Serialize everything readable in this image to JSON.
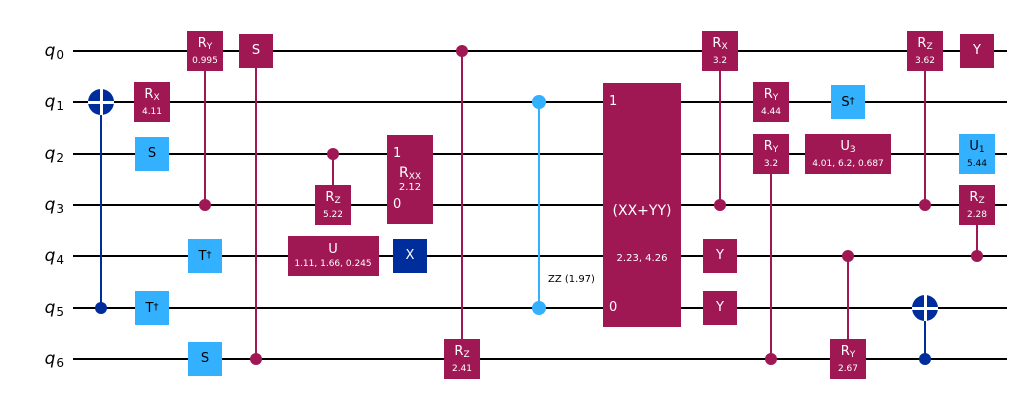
{
  "diagram_type": "quantum-circuit",
  "colors": {
    "rotation": "#9F1853",
    "clifford": "#33B1FF",
    "pauli": "#002D9C",
    "wire": "#000000",
    "zz": "#33B1FF",
    "background": "#ffffff",
    "text_on_dark": "#ffffff",
    "text_on_light": "#000000"
  },
  "qubits": [
    {
      "label": "q",
      "sub": "0"
    },
    {
      "label": "q",
      "sub": "1"
    },
    {
      "label": "q",
      "sub": "2"
    },
    {
      "label": "q",
      "sub": "3"
    },
    {
      "label": "q",
      "sub": "4"
    },
    {
      "label": "q",
      "sub": "5"
    },
    {
      "label": "q",
      "sub": "6"
    }
  ],
  "circuit": {
    "gates": [
      {
        "name": "cx-gate",
        "type": "cx",
        "column": 1,
        "control": 5,
        "target": 1
      },
      {
        "name": "rx-gate",
        "type": "gate",
        "column": 2,
        "qubit": 1,
        "label": "R",
        "sub": "X",
        "param": "4.11",
        "color": "rotation"
      },
      {
        "name": "s-gate",
        "type": "gate",
        "column": 2,
        "qubit": 2,
        "label": "S",
        "color": "clifford"
      },
      {
        "name": "tdg-gate",
        "type": "gate",
        "column": 2,
        "qubit": 5,
        "label": "T",
        "sup": "†",
        "color": "clifford"
      },
      {
        "name": "cry-gate",
        "type": "gate",
        "column": 3,
        "qubit": 0,
        "label": "R",
        "sub": "Y",
        "param": "0.995",
        "color": "rotation",
        "control": 3
      },
      {
        "name": "tdg-gate",
        "type": "gate",
        "column": 3,
        "qubit": 4,
        "label": "T",
        "sup": "†",
        "color": "clifford"
      },
      {
        "name": "s-gate",
        "type": "gate",
        "column": 3,
        "qubit": 6,
        "label": "S",
        "color": "clifford"
      },
      {
        "name": "cs-gate",
        "type": "gate",
        "column": 4,
        "qubit": 0,
        "label": "S",
        "color": "rotation",
        "control": 6
      },
      {
        "name": "crz-gate",
        "type": "gate",
        "column": 5,
        "qubit": 3,
        "label": "R",
        "sub": "Z",
        "param": "5.22",
        "color": "rotation",
        "control": 2
      },
      {
        "name": "u-gate",
        "type": "gate",
        "column": 5,
        "qubit": 4,
        "label": "U",
        "param": "1.11, 1.66, 0.245",
        "color": "rotation"
      },
      {
        "name": "rxx-gate",
        "type": "multibox",
        "column": 6,
        "top": 2,
        "bottom": 3,
        "label": "R",
        "sub": "XX",
        "param": "2.12",
        "color": "rotation",
        "ports": [
          {
            "qubit": 2,
            "label": "1"
          },
          {
            "qubit": 3,
            "label": "0"
          }
        ]
      },
      {
        "name": "x-gate",
        "type": "gate",
        "column": 6,
        "qubit": 4,
        "label": "X",
        "color": "pauli"
      },
      {
        "name": "crz-gate",
        "type": "gate",
        "column": 7,
        "qubit": 6,
        "label": "R",
        "sub": "Z",
        "param": "2.41",
        "color": "rotation",
        "control": 0
      },
      {
        "name": "rzz-gate",
        "type": "zz",
        "column": 8,
        "qubit_a": 1,
        "qubit_b": 5,
        "label": "ZZ (1.97)"
      },
      {
        "name": "xx-plus-yy-gate",
        "type": "multibox",
        "column": 9,
        "top": 1,
        "bottom": 5,
        "label": "(XX+YY)",
        "param": "2.23, 4.26",
        "color": "rotation",
        "ports": [
          {
            "qubit": 1,
            "label": "1"
          },
          {
            "qubit": 5,
            "label": "0"
          }
        ]
      },
      {
        "name": "crx-gate",
        "type": "gate",
        "column": 10,
        "qubit": 0,
        "label": "R",
        "sub": "X",
        "param": "3.2",
        "color": "rotation",
        "control": 3
      },
      {
        "name": "y-gate",
        "type": "gate",
        "column": 10,
        "qubit": 4,
        "label": "Y",
        "color": "rotation"
      },
      {
        "name": "y-gate",
        "type": "gate",
        "column": 10,
        "qubit": 5,
        "label": "Y",
        "color": "rotation"
      },
      {
        "name": "ry-gate",
        "type": "gate",
        "column": 11,
        "qubit": 1,
        "label": "R",
        "sub": "Y",
        "param": "4.44",
        "color": "rotation"
      },
      {
        "name": "cry-gate",
        "type": "gate",
        "column": 11,
        "qubit": 2,
        "label": "R",
        "sub": "Y",
        "param": "3.2",
        "color": "rotation",
        "control": 6
      },
      {
        "name": "sdg-gate",
        "type": "gate",
        "column": 12,
        "qubit": 1,
        "label": "S",
        "sup": "†",
        "color": "clifford"
      },
      {
        "name": "u3-gate",
        "type": "gate",
        "column": 12,
        "qubit": 2,
        "label": "U",
        "sub": "3",
        "param": "4.01, 6.2, 0.687",
        "color": "rotation"
      },
      {
        "name": "cry-gate",
        "type": "gate",
        "column": 12,
        "qubit": 6,
        "label": "R",
        "sub": "Y",
        "param": "2.67",
        "color": "rotation",
        "control": 4
      },
      {
        "name": "crz-gate",
        "type": "gate",
        "column": 13,
        "qubit": 0,
        "label": "R",
        "sub": "Z",
        "param": "3.62",
        "color": "rotation",
        "control": 3
      },
      {
        "name": "cx-gate",
        "type": "cx",
        "column": 13,
        "control": 6,
        "target": 5
      },
      {
        "name": "y-gate",
        "type": "gate",
        "column": 14,
        "qubit": 0,
        "label": "Y",
        "color": "rotation"
      },
      {
        "name": "u1-gate",
        "type": "gate",
        "column": 14,
        "qubit": 2,
        "label": "U",
        "sub": "1",
        "param": "5.44",
        "color": "clifford"
      },
      {
        "name": "crz-gate",
        "type": "gate",
        "column": 14,
        "qubit": 3,
        "label": "R",
        "sub": "Z",
        "param": "2.28",
        "color": "rotation",
        "control": 4
      }
    ]
  }
}
